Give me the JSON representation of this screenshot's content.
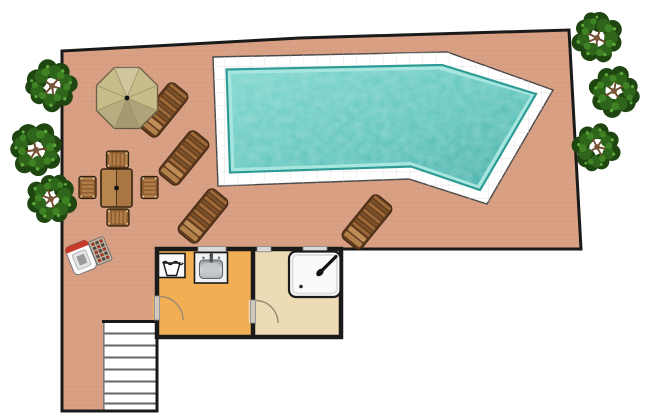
{
  "document": {
    "type": "floor-plan",
    "description": "Top-down architectural plan of a pool terrace with swimming pool, trees, garden furniture, two small rooms and an exterior staircase",
    "background": "#ffffff"
  },
  "palette": {
    "terrace": "#D9A084",
    "terraceGrid": "#C08E72",
    "outline": "#1A1A1A",
    "poolDeck": "#FFFFFF",
    "poolDeckLine": "#E2E2E2",
    "poolDeckEdge": "#4A4A4A",
    "waterBand": "#A7E6DF",
    "waterMid": "#74D2CA",
    "waterDeep": "#46AFA8",
    "waterRim": "#2E9C95",
    "roomOrange": "#F2AE54",
    "roomBeige": "#EDDBB6",
    "windowFill": "#D9D9D9",
    "windowEdge": "#808080",
    "doorLeaf": "#CFC8BC",
    "doorArc": "#9A8A72",
    "stairTread": "#666666",
    "woodFrame": "#5E3A1F",
    "woodMid": "#A06A38",
    "woodDeep": "#7C5128",
    "woodLight": "#BE8C55",
    "tableWoodA": "#B9854F",
    "tableWoodB": "#A97643",
    "chairBase": "#8A5A2E",
    "chairSlat": "#B07C48",
    "parasol": "#C8BC8B",
    "parasolEdge": "#6B6148",
    "parasolSeam": "#9C9168",
    "treeDark": "#1F4511",
    "treeMid": "#2F651B",
    "treeLight": "#3E8224",
    "treeHighlight": "#5CA838",
    "trunk": "#7B5537",
    "branch": "#6E4C2E",
    "bbqRed": "#C63A28",
    "bbqPanel": "#BDB6A8",
    "fixtureWhite": "#FAFAFA",
    "fixtureEdge": "#1A1A1A",
    "sinkSteelDark": "#8E9498",
    "sinkSteelLight": "#D7DADC"
  },
  "inventory": {
    "pool": {
      "shape": "irregular pentagon",
      "deck": "white tiled border",
      "water": "teal"
    },
    "trees": {
      "left_edge": 3,
      "right_edge": 3
    },
    "sun_loungers": 4,
    "parasols": 1,
    "dining_set": {
      "tables": 1,
      "chairs": 4
    },
    "barbecues": 1,
    "rooms": [
      {
        "name": "utility room",
        "fill": "orange",
        "fixtures": [
          "laundry basket",
          "washbasin"
        ],
        "doors": 1,
        "windows": 1
      },
      {
        "name": "shower room",
        "fill": "beige",
        "fixtures": [
          "shower tray"
        ],
        "doors": 1,
        "windows": 2
      }
    ],
    "stairs": {
      "treads": 7,
      "location": "bottom left"
    }
  }
}
